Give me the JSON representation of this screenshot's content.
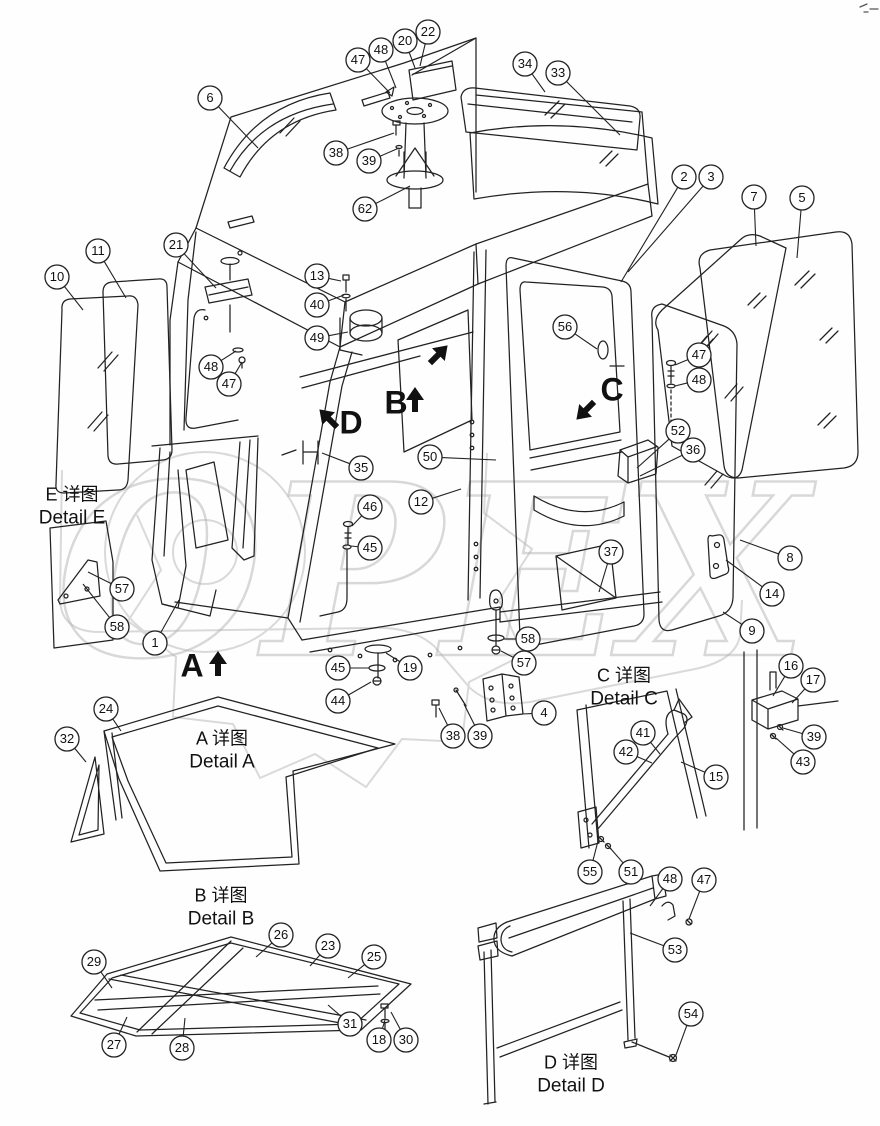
{
  "watermark": {
    "text": "OPEX",
    "color": "#b5b5b5"
  },
  "detail_labels": [
    {
      "id": "e",
      "zh": "E 详图",
      "en": "Detail E",
      "x": 72,
      "y": 507
    },
    {
      "id": "a",
      "zh": "A 详图",
      "en": "Detail A",
      "x": 222,
      "y": 751
    },
    {
      "id": "b",
      "zh": "B 详图",
      "en": "Detail B",
      "x": 221,
      "y": 908
    },
    {
      "id": "c",
      "zh": "C 详图",
      "en": "Detail C",
      "x": 624,
      "y": 688
    },
    {
      "id": "d",
      "zh": "D 详图",
      "en": "Detail D",
      "x": 571,
      "y": 1075
    }
  ],
  "view_markers": [
    {
      "label": "A",
      "lx": 192,
      "ly": 668,
      "ax": 218,
      "ay": 666,
      "dir": "up"
    },
    {
      "label": "B",
      "lx": 396,
      "ly": 405,
      "ax": 415,
      "ay": 402,
      "dir": "up"
    },
    {
      "label": "C",
      "lx": 612,
      "ly": 392,
      "ax": 587,
      "ay": 409,
      "dir": "down-left"
    },
    {
      "label": "D",
      "lx": 351,
      "ly": 425,
      "ax": 330,
      "ay": 420,
      "dir": "up-left"
    },
    {
      "label": "",
      "lx": -100,
      "ly": -100,
      "ax": 437,
      "ay": 356,
      "dir": "up-right"
    }
  ],
  "callouts": [
    {
      "n": "47",
      "x": 358,
      "y": 60,
      "lx": 390,
      "ly": 93
    },
    {
      "n": "48",
      "x": 381,
      "y": 50,
      "lx": 396,
      "ly": 88
    },
    {
      "n": "20",
      "x": 405,
      "y": 41,
      "lx": 415,
      "ly": 68
    },
    {
      "n": "22",
      "x": 428,
      "y": 32,
      "lx": 420,
      "ly": 66
    },
    {
      "n": "34",
      "x": 525,
      "y": 64,
      "lx": 545,
      "ly": 92
    },
    {
      "n": "33",
      "x": 558,
      "y": 73,
      "lx": 620,
      "ly": 135
    },
    {
      "n": "6",
      "x": 210,
      "y": 98,
      "lx": 258,
      "ly": 148
    },
    {
      "n": "38",
      "x": 336,
      "y": 153,
      "lx": 394,
      "ly": 133
    },
    {
      "n": "39",
      "x": 369,
      "y": 161,
      "lx": 399,
      "ly": 148
    },
    {
      "n": "62",
      "x": 365,
      "y": 209,
      "lx": 410,
      "ly": 186
    },
    {
      "n": "2",
      "x": 684,
      "y": 177,
      "lx": 621,
      "ly": 282
    },
    {
      "n": "3",
      "x": 711,
      "y": 177,
      "lx": 628,
      "ly": 272
    },
    {
      "n": "7",
      "x": 754,
      "y": 197,
      "lx": 756,
      "ly": 246
    },
    {
      "n": "5",
      "x": 802,
      "y": 198,
      "lx": 797,
      "ly": 258
    },
    {
      "n": "11",
      "x": 98,
      "y": 251,
      "lx": 126,
      "ly": 298
    },
    {
      "n": "21",
      "x": 176,
      "y": 245,
      "lx": 216,
      "ly": 288
    },
    {
      "n": "10",
      "x": 57,
      "y": 277,
      "lx": 83,
      "ly": 310
    },
    {
      "n": "13",
      "x": 317,
      "y": 276,
      "lx": 341,
      "ly": 281
    },
    {
      "n": "40",
      "x": 317,
      "y": 305,
      "lx": 344,
      "ly": 295
    },
    {
      "n": "49",
      "x": 317,
      "y": 338,
      "lx": 348,
      "ly": 332
    },
    {
      "n": "48",
      "x": 211,
      "y": 367,
      "lx": 236,
      "ly": 351
    },
    {
      "n": "47",
      "x": 229,
      "y": 384,
      "lx": 242,
      "ly": 362
    },
    {
      "n": "56",
      "x": 565,
      "y": 327,
      "lx": 597,
      "ly": 349
    },
    {
      "n": "47",
      "x": 699,
      "y": 355,
      "lx": 675,
      "ly": 365
    },
    {
      "n": "48",
      "x": 699,
      "y": 380,
      "lx": 675,
      "ly": 386
    },
    {
      "n": "35",
      "x": 361,
      "y": 468,
      "lx": 322,
      "ly": 453
    },
    {
      "n": "50",
      "x": 430,
      "y": 457,
      "lx": 496,
      "ly": 460
    },
    {
      "n": "12",
      "x": 421,
      "y": 502,
      "lx": 461,
      "ly": 489
    },
    {
      "n": "46",
      "x": 370,
      "y": 507,
      "lx": 352,
      "ly": 526
    },
    {
      "n": "45",
      "x": 370,
      "y": 548,
      "lx": 351,
      "ly": 546
    },
    {
      "n": "52",
      "x": 678,
      "y": 431,
      "lx": 637,
      "ly": 468
    },
    {
      "n": "36",
      "x": 693,
      "y": 450,
      "lx": 640,
      "ly": 476
    },
    {
      "n": "37",
      "x": 611,
      "y": 552,
      "lx": 599,
      "ly": 592
    },
    {
      "n": "8",
      "x": 790,
      "y": 558,
      "lx": 740,
      "ly": 540
    },
    {
      "n": "14",
      "x": 772,
      "y": 594,
      "lx": 726,
      "ly": 560
    },
    {
      "n": "9",
      "x": 752,
      "y": 631,
      "lx": 723,
      "ly": 612
    },
    {
      "n": "57",
      "x": 122,
      "y": 589,
      "lx": 88,
      "ly": 572
    },
    {
      "n": "58",
      "x": 117,
      "y": 627,
      "lx": 83,
      "ly": 584
    },
    {
      "n": "1",
      "x": 155,
      "y": 643,
      "lx": 179,
      "ly": 600
    },
    {
      "n": "45",
      "x": 338,
      "y": 668,
      "lx": 369,
      "ly": 668
    },
    {
      "n": "19",
      "x": 410,
      "y": 668,
      "lx": 386,
      "ly": 653
    },
    {
      "n": "44",
      "x": 338,
      "y": 701,
      "lx": 371,
      "ly": 682
    },
    {
      "n": "38",
      "x": 453,
      "y": 736,
      "lx": 439,
      "ly": 708
    },
    {
      "n": "39",
      "x": 480,
      "y": 736,
      "lx": 464,
      "ly": 704
    },
    {
      "n": "4",
      "x": 544,
      "y": 713,
      "lx": 522,
      "ly": 714
    },
    {
      "n": "58",
      "x": 528,
      "y": 639,
      "lx": 504,
      "ly": 639
    },
    {
      "n": "57",
      "x": 524,
      "y": 663,
      "lx": 501,
      "ly": 651
    },
    {
      "n": "24",
      "x": 106,
      "y": 709,
      "lx": 121,
      "ly": 731
    },
    {
      "n": "32",
      "x": 67,
      "y": 739,
      "lx": 86,
      "ly": 762
    },
    {
      "n": "16",
      "x": 791,
      "y": 666,
      "lx": 773,
      "ly": 696
    },
    {
      "n": "17",
      "x": 813,
      "y": 680,
      "lx": 792,
      "ly": 703
    },
    {
      "n": "39",
      "x": 814,
      "y": 737,
      "lx": 783,
      "ly": 728
    },
    {
      "n": "43",
      "x": 803,
      "y": 762,
      "lx": 776,
      "ly": 738
    },
    {
      "n": "41",
      "x": 643,
      "y": 733,
      "lx": 660,
      "ly": 754
    },
    {
      "n": "42",
      "x": 626,
      "y": 752,
      "lx": 652,
      "ly": 763
    },
    {
      "n": "15",
      "x": 716,
      "y": 777,
      "lx": 681,
      "ly": 762
    },
    {
      "n": "55",
      "x": 590,
      "y": 872,
      "lx": 598,
      "ly": 841
    },
    {
      "n": "51",
      "x": 631,
      "y": 872,
      "lx": 611,
      "ly": 849
    },
    {
      "n": "48",
      "x": 670,
      "y": 879,
      "lx": 650,
      "ly": 906
    },
    {
      "n": "47",
      "x": 704,
      "y": 880,
      "lx": 689,
      "ly": 919
    },
    {
      "n": "53",
      "x": 675,
      "y": 950,
      "lx": 630,
      "ly": 933
    },
    {
      "n": "54",
      "x": 691,
      "y": 1014,
      "lx": 676,
      "ly": 1055
    },
    {
      "n": "26",
      "x": 281,
      "y": 935,
      "lx": 256,
      "ly": 957
    },
    {
      "n": "23",
      "x": 328,
      "y": 946,
      "lx": 310,
      "ly": 966
    },
    {
      "n": "25",
      "x": 374,
      "y": 957,
      "lx": 348,
      "ly": 978
    },
    {
      "n": "29",
      "x": 94,
      "y": 962,
      "lx": 112,
      "ly": 988
    },
    {
      "n": "31",
      "x": 350,
      "y": 1024,
      "lx": 328,
      "ly": 1005
    },
    {
      "n": "27",
      "x": 114,
      "y": 1045,
      "lx": 127,
      "ly": 1017
    },
    {
      "n": "28",
      "x": 182,
      "y": 1048,
      "lx": 185,
      "ly": 1018
    },
    {
      "n": "18",
      "x": 379,
      "y": 1040,
      "lx": 385,
      "ly": 1020
    },
    {
      "n": "30",
      "x": 406,
      "y": 1040,
      "lx": 391,
      "ly": 1012
    }
  ]
}
